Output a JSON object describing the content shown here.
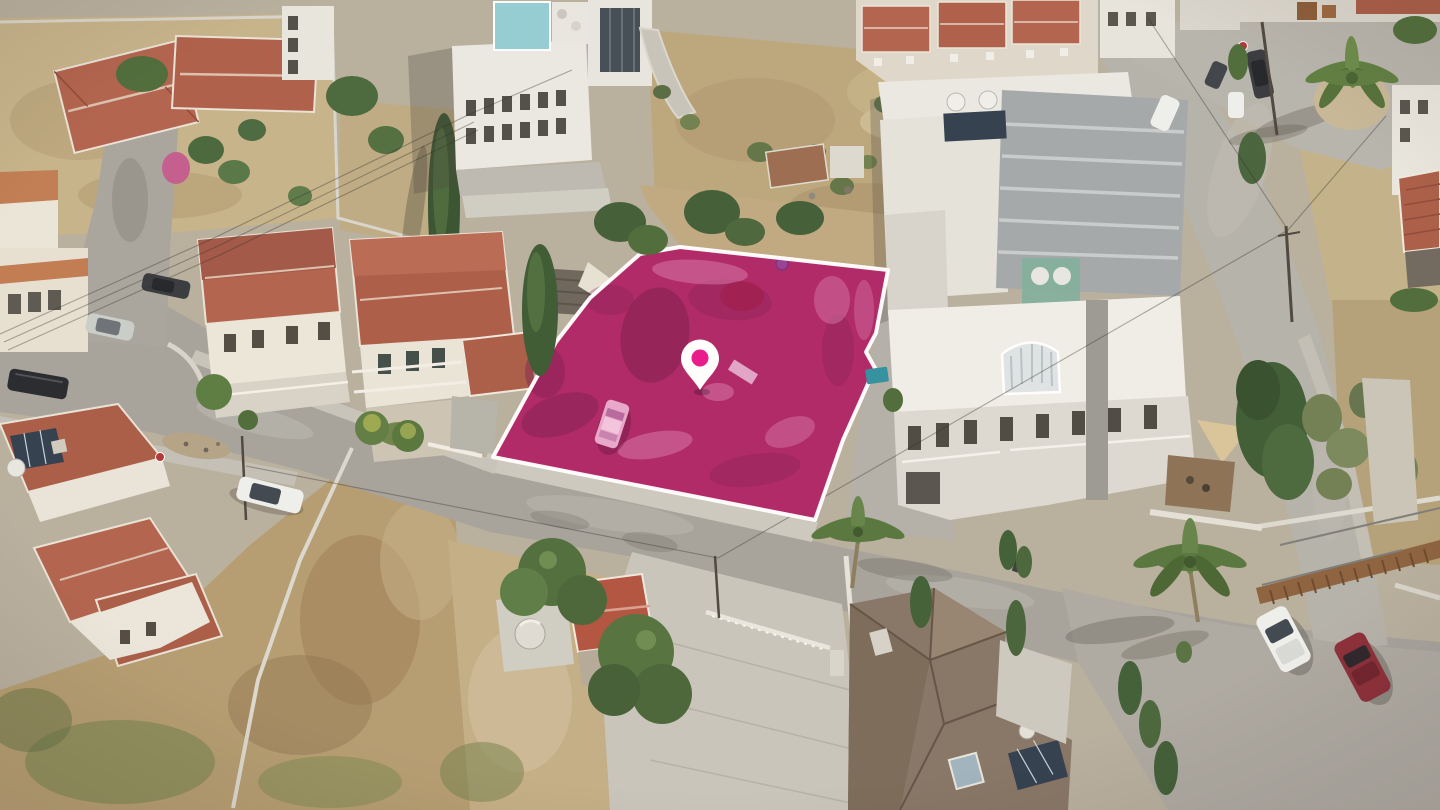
{
  "image": {
    "type": "aerial-drone-photograph",
    "description": "Aerial drone view of a sunlit residential neighborhood with a vacant land plot highlighted in magenta and marked with a white map pin",
    "setting": "suburban streets, terracotta-roofed houses, white apartment buildings, dry fields, palm and cypress trees, parked cars"
  },
  "highlight": {
    "label": "highlighted land plot",
    "shape": "irregular polygon outlined in white",
    "contains": [
      "parked car tinted pink",
      "large shrub",
      "small purple barrel",
      "concrete slab"
    ]
  },
  "marker": {
    "icon": "map-pin-icon",
    "style": "white teardrop pin with magenta dot"
  },
  "colors": {
    "plot_highlight": "#ae2465",
    "plot_border": "#ffffff",
    "pin_fill": "#ffffff",
    "pin_dot": "#e81489",
    "road": "#a5a29b",
    "asphalt_light": "#b4b1a9",
    "concrete": "#cbc8bf",
    "dry_field": "#c0a97c",
    "scrub_green": "#75854c",
    "terracotta_roof": "#b0604a",
    "brown_roof": "#857363",
    "white_building": "#ebe9e2",
    "metal_roof": "#a3a7a9",
    "penthouse_blue": "#92ccd3",
    "tree_green": "#4c6a38",
    "cypress_green": "#35502c",
    "solar_panel": "#2f3c4b",
    "car_white": "#eef0ec",
    "car_red": "#8a2a35",
    "car_dark": "#33373c",
    "car_pink": "#e7a6c9",
    "shade_sail": "#d9c49a",
    "stair_wood": "#8a5f3c"
  }
}
